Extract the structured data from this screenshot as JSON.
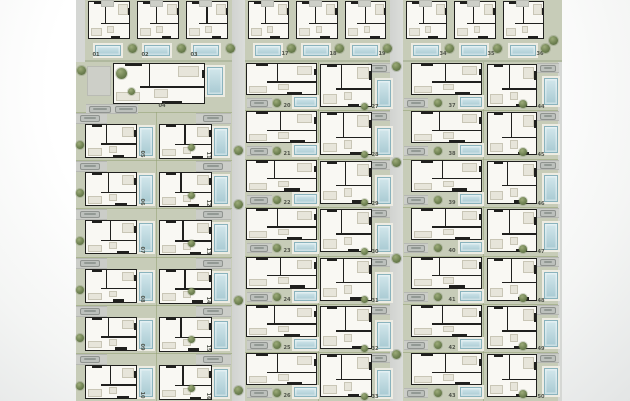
{
  "document": {
    "type": "residential-site-plan",
    "units_total": 50
  },
  "colors": {
    "background": "#ffffff",
    "road": "#d5d7d4",
    "plot_green": "#c7ccb8",
    "house_fill": "#f9f8f3",
    "wall": "#20201e",
    "pool": "#b7d8e0",
    "pool_border": "#8ab3bd",
    "pool_deck": "#edece3",
    "driveway": "#cbcdc8",
    "car": "#bcc0bc",
    "tree": "#697c4d",
    "hedge": "#91a073",
    "label": "#50544b"
  },
  "blocks": {
    "top_row": {
      "groups": [
        {
          "id": "top-left",
          "units": [
            "01",
            "02",
            "03"
          ]
        },
        {
          "id": "top-middle",
          "units": [
            "17",
            "18",
            "19"
          ]
        },
        {
          "id": "top-right",
          "units": [
            "34",
            "35",
            "36"
          ]
        }
      ]
    },
    "left_block": {
      "detached_unit": "04",
      "col_a": [
        "05",
        "06",
        "07",
        "08",
        "09",
        "10"
      ],
      "col_b": [
        "11",
        "12",
        "13",
        "14",
        "15",
        "16"
      ]
    },
    "middle_block": {
      "col_a": [
        "20",
        "21",
        "22",
        "23",
        "24",
        "25",
        "26"
      ],
      "col_b": [
        "27",
        "28",
        "29",
        "30",
        "31",
        "32",
        "33"
      ]
    },
    "right_block": {
      "col_a": [
        "37",
        "38",
        "39",
        "40",
        "41",
        "42",
        "43"
      ],
      "col_b": [
        "44",
        "45",
        "46",
        "47",
        "48",
        "49",
        "50"
      ]
    }
  }
}
